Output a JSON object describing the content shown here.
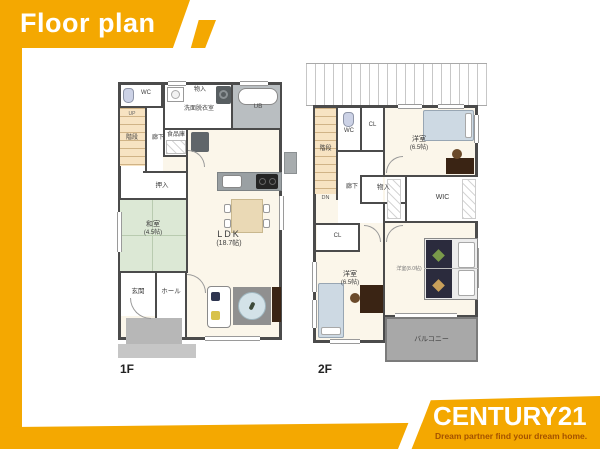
{
  "banner": {
    "title": "Floor plan"
  },
  "colors": {
    "brand_yellow": "#F4A801",
    "tagline_text": "#A35100",
    "wall_gray": "#4B4B4B",
    "floor_cream": "#FBF6EA",
    "tatami_green": "#DCE8D5",
    "balcony_gray": "#A8A8A8"
  },
  "floor1": {
    "floor_label": "1F",
    "labels": {
      "wc": "WC",
      "storage_top": "物入",
      "washroom": "洗面脱衣室",
      "bath": "UB",
      "stairs": "階段",
      "stairs_dir": "UP",
      "hallway": "廊下",
      "pantry": "食品庫",
      "closet": "押入",
      "tatami_room": "和室",
      "tatami_size": "(4.5帖)",
      "ldk": "LDK",
      "ldk_size": "(18.7帖)",
      "entrance": "玄関",
      "hall": "ホール"
    }
  },
  "floor2": {
    "floor_label": "2F",
    "labels": {
      "wc": "WC",
      "closet_top": "CL",
      "bedroom1": "洋室",
      "bedroom1_size": "(6.5帖)",
      "stairs": "階段",
      "stairs_dir": "DN",
      "hallway": "廊下",
      "storage": "物入",
      "wic": "WIC",
      "closet2": "CL",
      "bedroom2": "洋室",
      "bedroom2_size": "(6.5帖)",
      "master": "洋室(8.0帖)",
      "balcony": "バルコニー"
    }
  },
  "logo": {
    "brand": "CENTURY21",
    "tagline": "Dream partner find your dream home."
  }
}
